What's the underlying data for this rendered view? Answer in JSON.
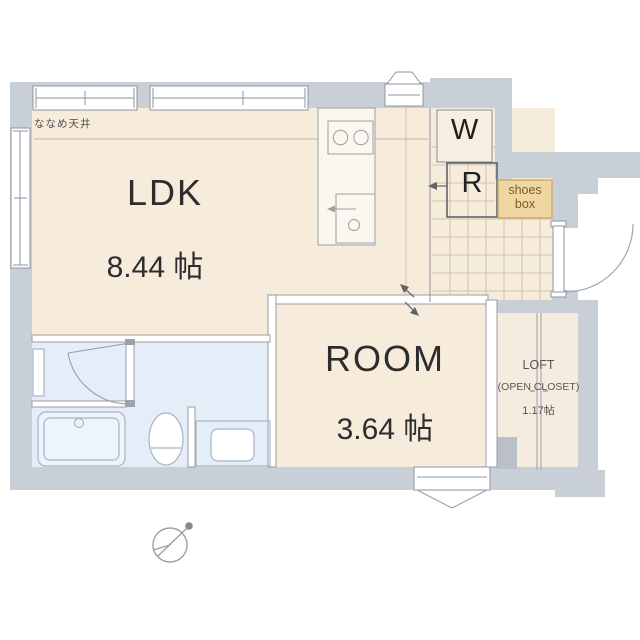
{
  "plan": {
    "ceiling_note": "ななめ天井",
    "ldk": {
      "name": "LDK",
      "area": "8.44 帖"
    },
    "room": {
      "name": "ROOM",
      "area": "3.64 帖"
    },
    "loft": {
      "name": "LOFT",
      "subtitle": "(OPEN CLOSET)",
      "area": "1.17帖"
    },
    "washer_label": "W",
    "fridge_label": "R",
    "shoes_box": {
      "line1": "shoes",
      "line2": "box"
    },
    "colors": {
      "exterior_wall": "#c9cfd7",
      "room_floor": "#f7ebdc",
      "wet_area_floor": "#e4edf8",
      "tile_grid_line": "#c6b89f",
      "fixture_line": "#a8b4c6",
      "shoes_box_fill": "#eed7a0",
      "shoes_box_text": "#7d5c28",
      "label_text": "#2d2d2d"
    },
    "fixture_icons": [
      "kitchen-stove",
      "kitchen-sink",
      "bathtub",
      "toilet",
      "vanity-sink",
      "entrance-door",
      "washroom-door",
      "compass"
    ]
  }
}
